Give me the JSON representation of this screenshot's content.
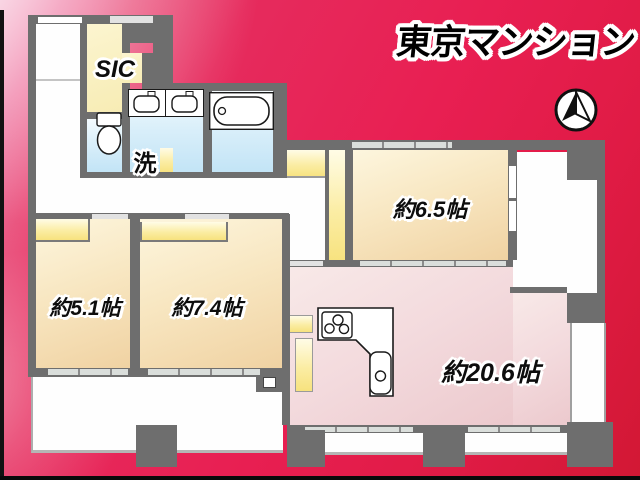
{
  "title": "東京マンション",
  "rooms": {
    "r65": {
      "label": "約6.5帖"
    },
    "r51": {
      "label": "約5.1帖"
    },
    "r74": {
      "label": "約7.4帖"
    },
    "ldk": {
      "label": "約20.6帖"
    },
    "sic": {
      "label": "SIC"
    },
    "wash": {
      "label": "洗"
    }
  },
  "icons": {
    "compass": "north-compass-icon",
    "bathtub": "bathtub-icon",
    "toilet": "toilet-icon",
    "washbasin": "double-washbasin-icon",
    "stove": "stove-icon",
    "kitchen_sink": "kitchen-sink-icon"
  },
  "colors": {
    "background_top": "#f3a5c4",
    "background_main": "#e71f52",
    "background_bottom": "#d21834",
    "wall": "#6e6e6e",
    "room_tan": "#f3d8ab",
    "closet_yellow": "#f9e784",
    "water_blue": "#cde8f7",
    "ldk_pink": "#efd2d5",
    "white_area": "#ffffff",
    "title_text": "#000000"
  }
}
